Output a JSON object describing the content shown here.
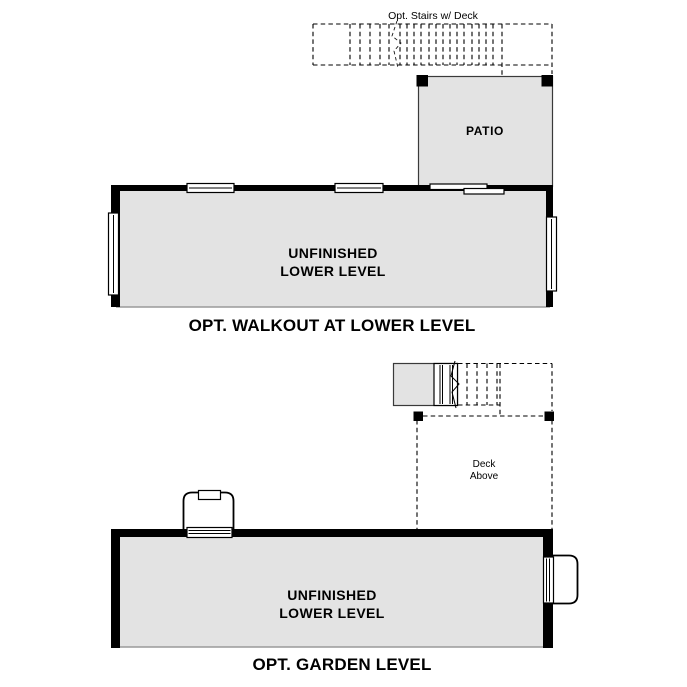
{
  "document": {
    "type": "floor-plan-options"
  },
  "colors": {
    "floor_fill": "#e3e3e3",
    "wall": "#000000",
    "background": "#ffffff"
  },
  "plans": {
    "walkout": {
      "title": "OPT. WALKOUT AT LOWER LEVEL",
      "stairs_label": "Opt. Stairs w/ Deck",
      "patio_label": "PATIO",
      "room_label_lines": [
        "UNFINISHED",
        "LOWER LEVEL"
      ]
    },
    "garden": {
      "title": "OPT. GARDEN LEVEL",
      "deck_label_lines": [
        "Deck",
        "Above"
      ],
      "room_label_lines": [
        "UNFINISHED",
        "LOWER LEVEL"
      ]
    }
  }
}
